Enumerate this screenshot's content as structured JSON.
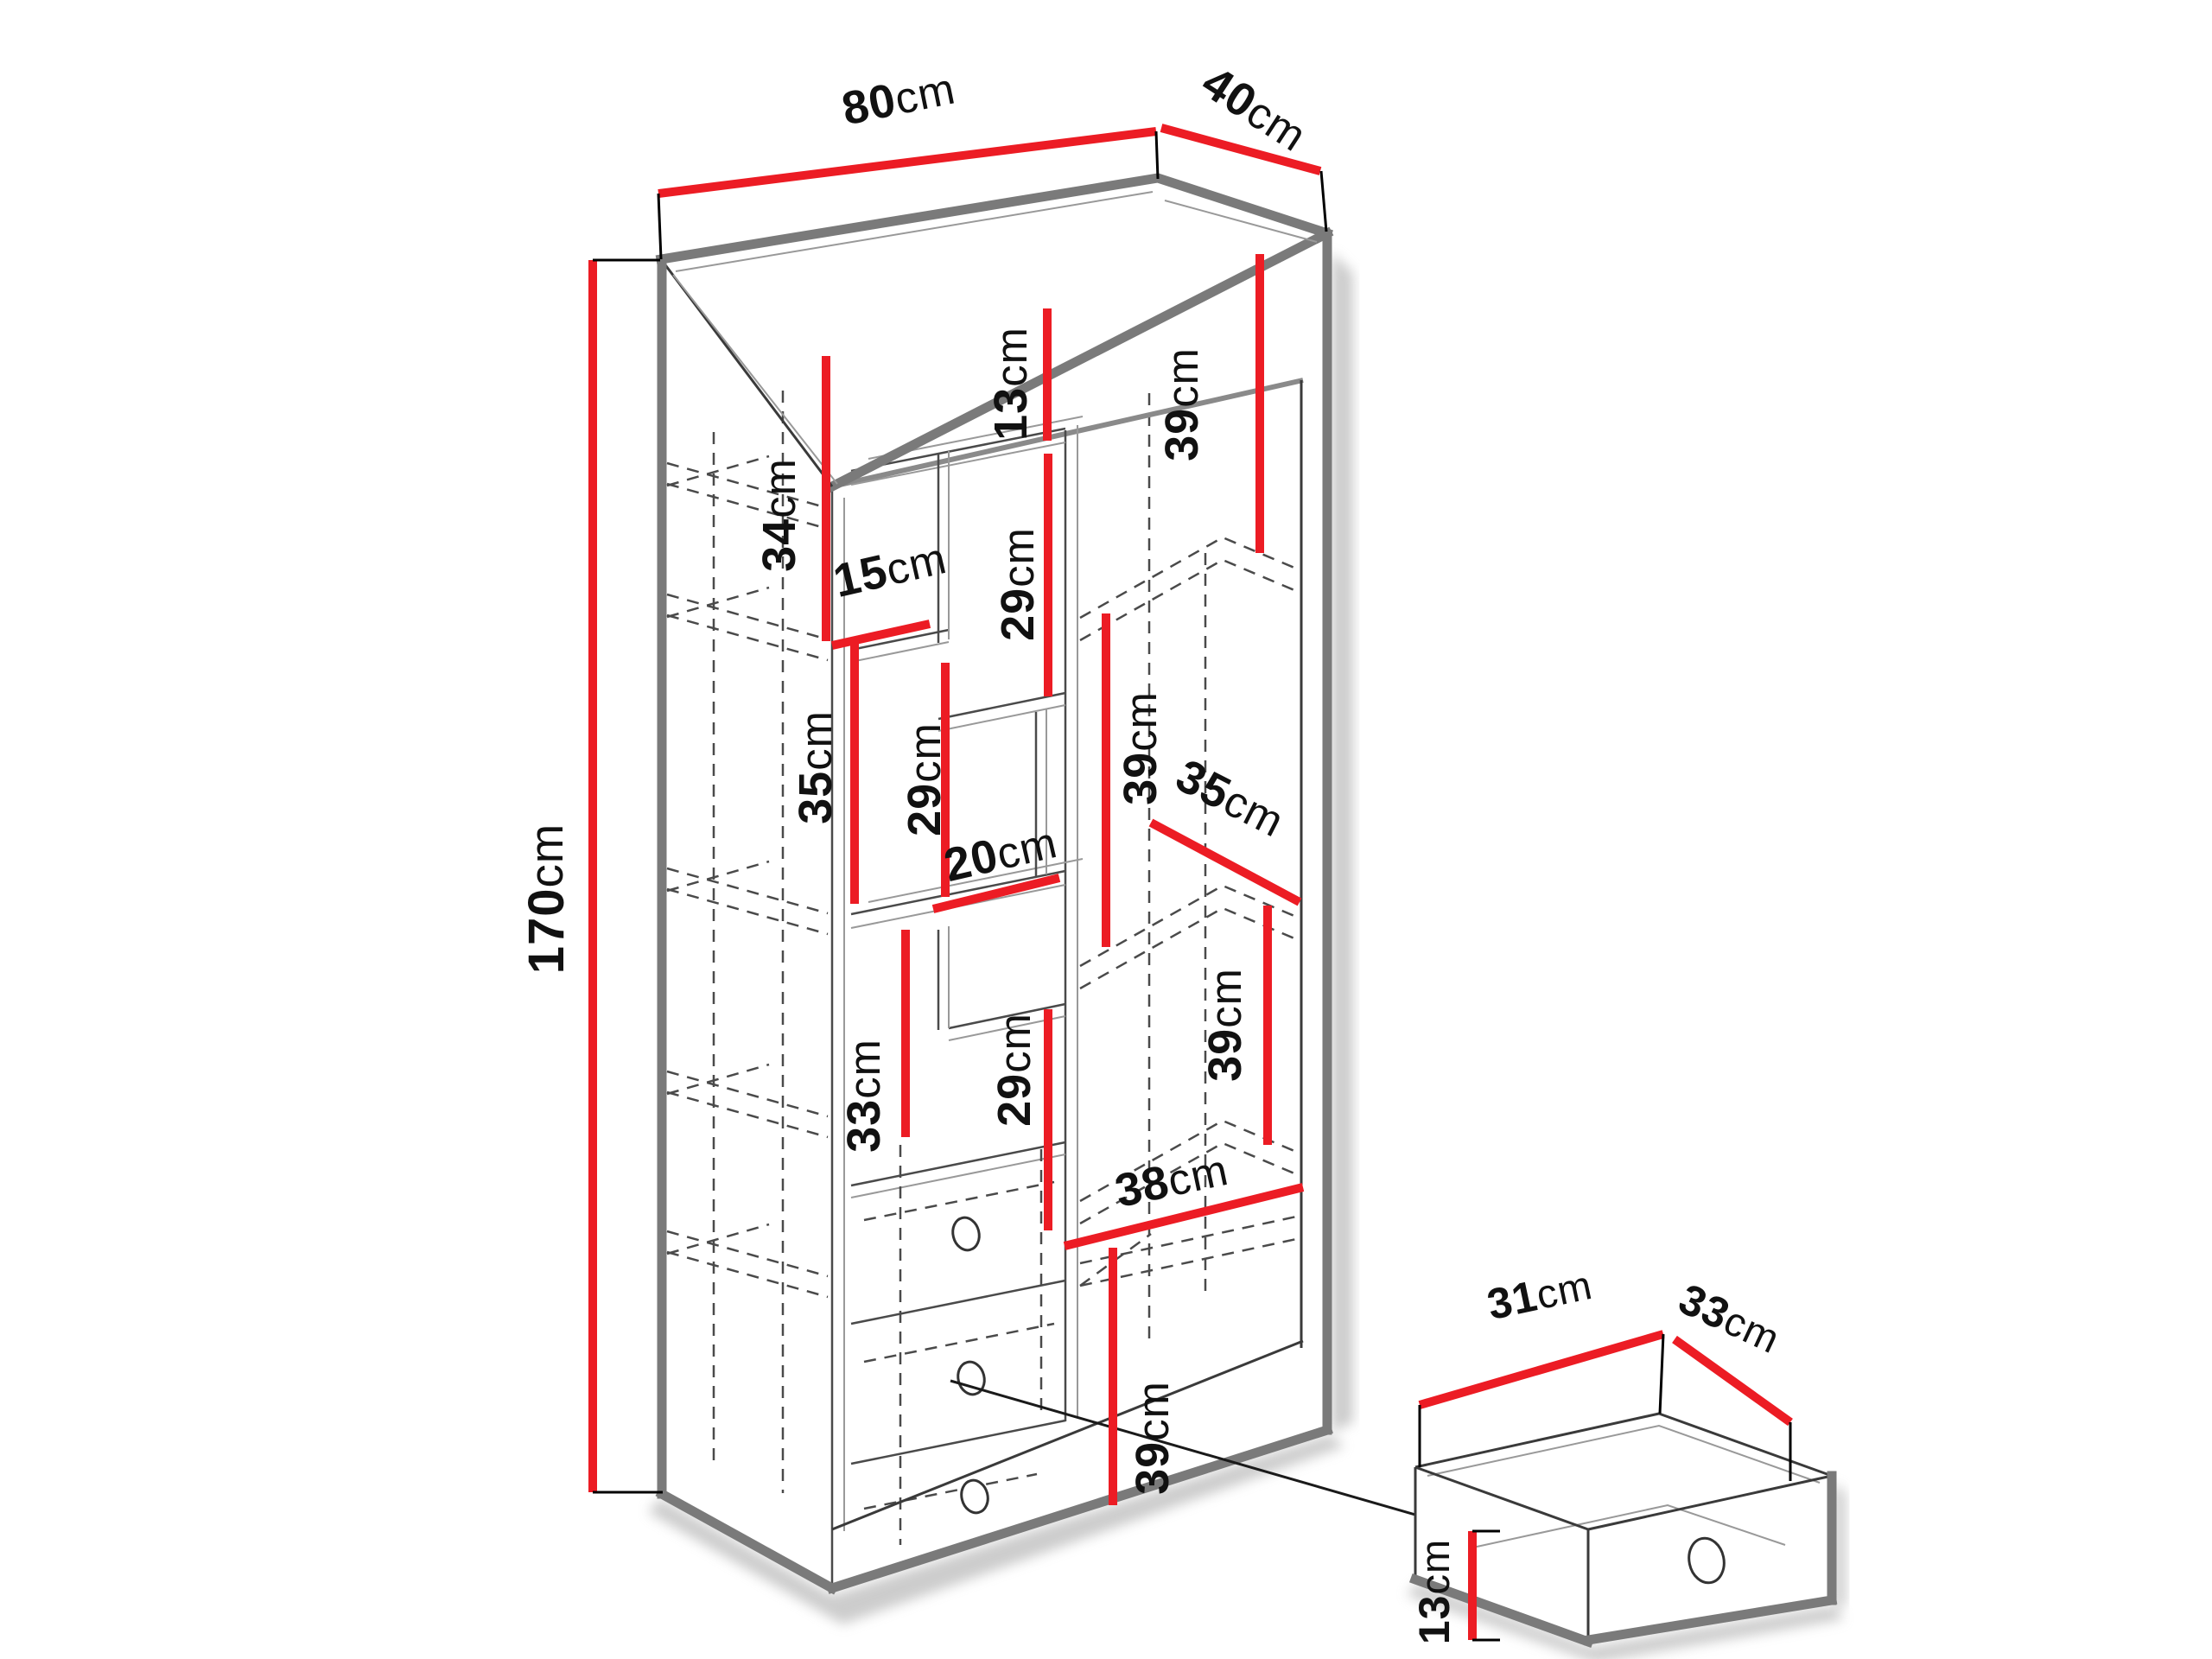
{
  "diagram": {
    "type": "furniture-dimension-diagram",
    "units": "cm",
    "colors": {
      "dimension_line": "#ec1c24",
      "edges": "#7a7a7a",
      "hidden_lines": "#4a4a4a",
      "text": "#111111",
      "background": "#ffffff"
    },
    "cabinet": {
      "overall_cm": {
        "width": 80,
        "depth": 40,
        "height": 170
      },
      "internal_measurements_cm": [
        34,
        13,
        29,
        39,
        15,
        35,
        29,
        20,
        39,
        35,
        39,
        33,
        29,
        38,
        39
      ],
      "drawers_in_cabinet": 3,
      "drawer_detail_cm": {
        "width": 31,
        "depth": 33,
        "front_height": 13
      }
    }
  },
  "dims": {
    "d_width": {
      "value": "80",
      "unit": "cm"
    },
    "d_depth": {
      "value": "40",
      "unit": "cm"
    },
    "d_height": {
      "value": "170",
      "unit": "cm"
    },
    "m34": {
      "value": "34",
      "unit": "cm"
    },
    "m13": {
      "value": "13",
      "unit": "cm"
    },
    "m29a": {
      "value": "29",
      "unit": "cm"
    },
    "m39a": {
      "value": "39",
      "unit": "cm"
    },
    "m15": {
      "value": "15",
      "unit": "cm"
    },
    "m35l": {
      "value": "35",
      "unit": "cm"
    },
    "m29b": {
      "value": "29",
      "unit": "cm"
    },
    "m20": {
      "value": "20",
      "unit": "cm"
    },
    "m39b": {
      "value": "39",
      "unit": "cm"
    },
    "m35r": {
      "value": "35",
      "unit": "cm"
    },
    "m39d": {
      "value": "39",
      "unit": "cm"
    },
    "m33": {
      "value": "33",
      "unit": "cm"
    },
    "m29c": {
      "value": "29",
      "unit": "cm"
    },
    "m38": {
      "value": "38",
      "unit": "cm"
    },
    "m39c": {
      "value": "39",
      "unit": "cm"
    },
    "dd31": {
      "value": "31",
      "unit": "cm"
    },
    "dd33": {
      "value": "33",
      "unit": "cm"
    },
    "dd13": {
      "value": "13",
      "unit": "cm"
    }
  }
}
